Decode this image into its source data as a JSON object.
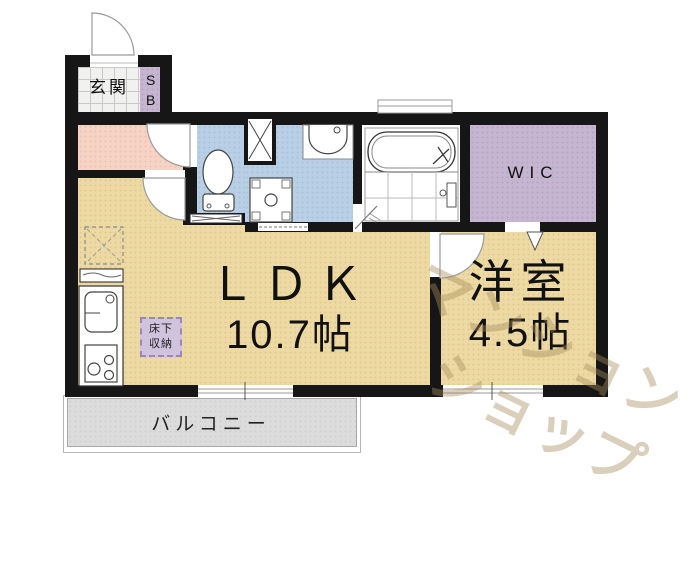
{
  "plan": {
    "title": "1LDK apartment floor plan",
    "rooms": {
      "genkan": {
        "label": "玄関"
      },
      "shoe_box": {
        "label": "SB"
      },
      "wic": {
        "label": "WIC"
      },
      "ldk": {
        "name": "ＬＤＫ",
        "size": "10.7帖"
      },
      "western_room": {
        "name": "洋室",
        "size": "4.5帖"
      },
      "floor_storage": {
        "line1": "床下",
        "line2": "収納"
      },
      "balcony": {
        "label": "バルコニー"
      }
    },
    "fixtures": [
      "entrance-door",
      "toilet",
      "washbasin",
      "washer-pan",
      "bathtub",
      "kitchen-sink",
      "stove",
      "refrigerator-space",
      "pipe-space"
    ],
    "watermark": {
      "line1": "マンション",
      "line2": "ショップ"
    },
    "colors": {
      "wall": "#161616",
      "tan": "#ecd9a4",
      "tan_dot": "#e2c98b",
      "pink": "#f7d3c5",
      "pink_dot": "#eec2b0",
      "blue": "#b8cfe5",
      "blue_dot": "#a9c2da",
      "purple": "#c6b5d1",
      "purple_dot": "#b7a4c5",
      "tile": "#f1f1f0",
      "tile_line": "#c9c9c9",
      "balcony": "#dcdcdc",
      "balcony_dot": "#d0d0d0",
      "storage_bg": "#cfc3dd",
      "storage_border": "#9b87b5",
      "watermark": "rgba(167,140,92,0.42)"
    }
  }
}
